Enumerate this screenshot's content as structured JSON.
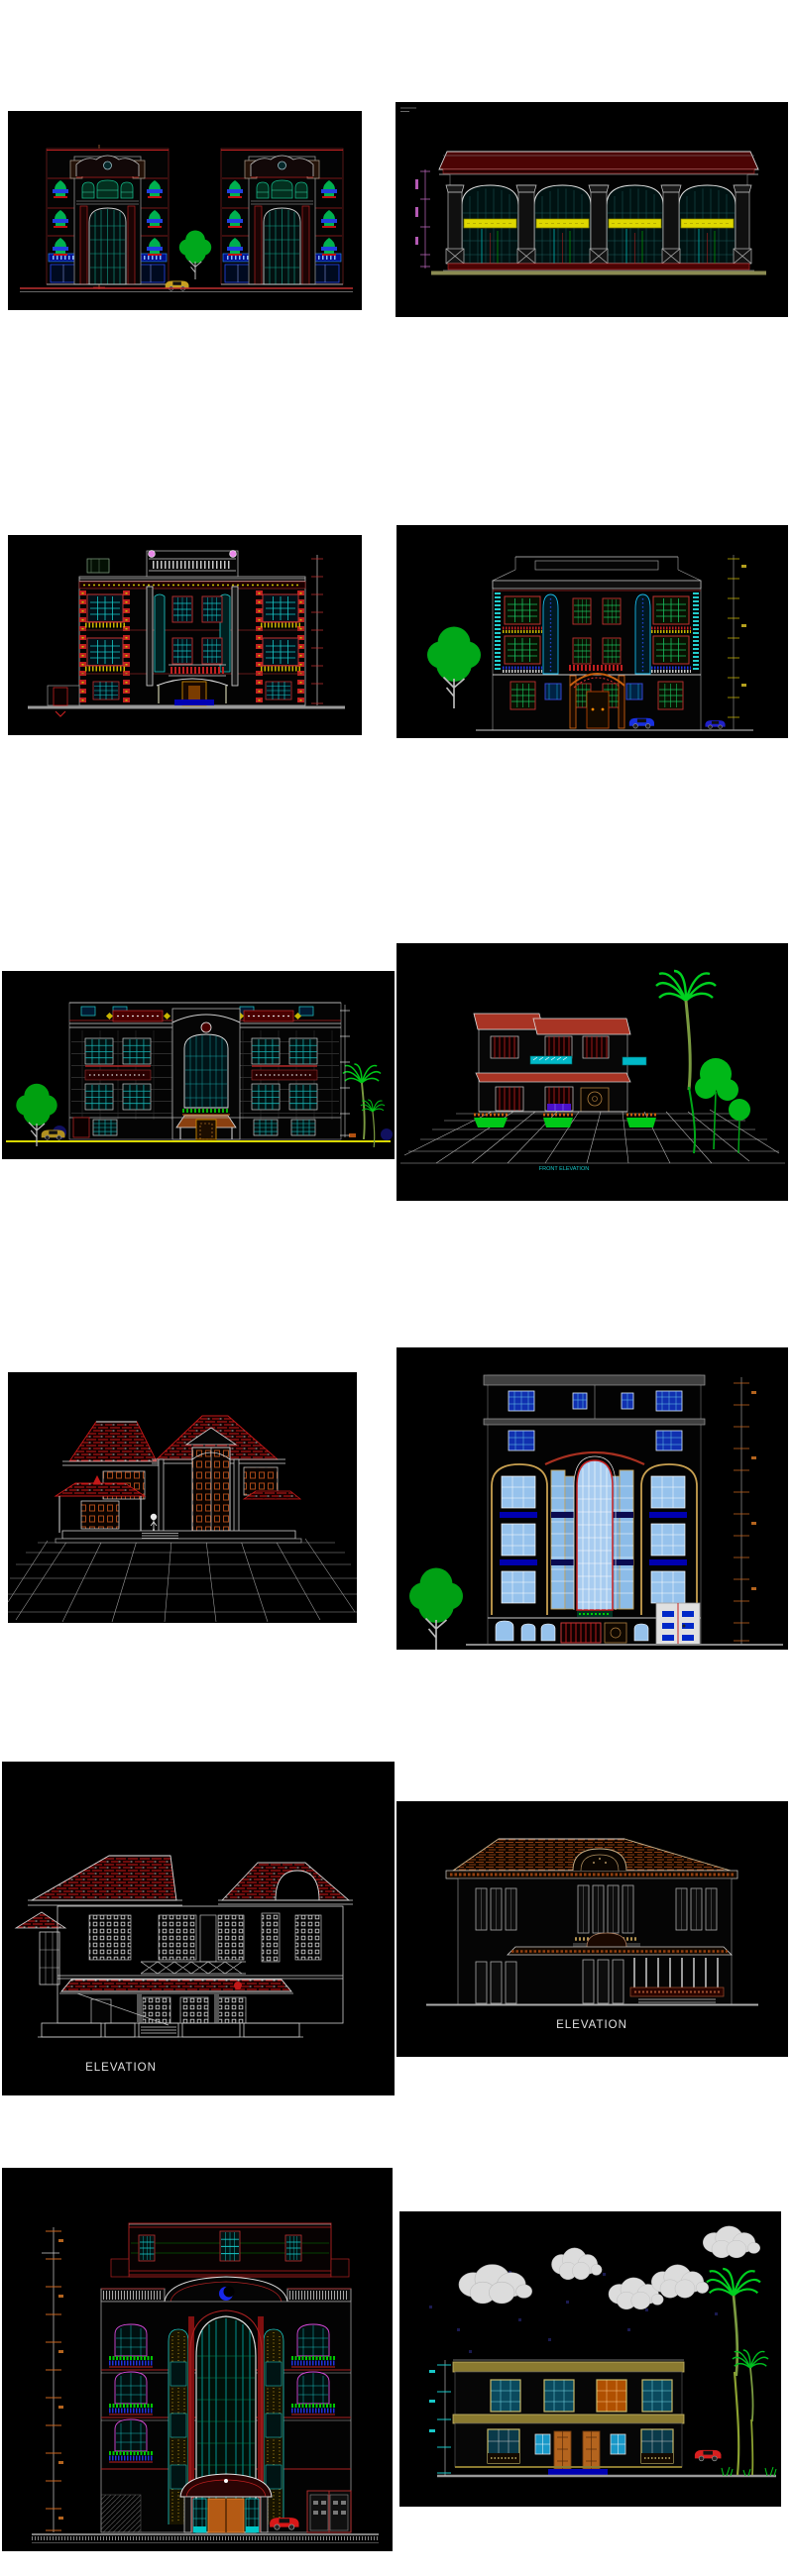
{
  "page": {
    "background": "#ffffff",
    "panel_background": "#000000",
    "caption_color": "#e0e0e0"
  },
  "palette": {
    "cad_red": "#c02020",
    "dark_red": "#4c0404",
    "yellow": "#ded800",
    "cyan": "#12c8c8",
    "teal": "#14b284",
    "green": "#00b400",
    "bright_green": "#00d020",
    "blue": "#2233dd",
    "royal_blue": "#0000b4",
    "light_blue": "#96c2ec",
    "magenta": "#d848d8",
    "orange": "#b4641e",
    "tan": "#c8a050",
    "khaki": "#8a7a30",
    "olive_ground": "#8a8a52",
    "gray": "#8a8a8a",
    "light_gray": "#d8d8d8",
    "cloud_gray": "#dcdcdc"
  },
  "panels": [
    {
      "name": "twin-retail-building-elevation",
      "caption": ""
    },
    {
      "name": "arched-warehouse-elevation",
      "caption": ""
    },
    {
      "name": "classical-villa-front-elevation",
      "caption": ""
    },
    {
      "name": "villa-rear-elevation-with-tree",
      "caption": ""
    },
    {
      "name": "wide-mansion-elevation",
      "caption": ""
    },
    {
      "name": "perspective-villa-with-palms",
      "caption": "FRONT ELEVATION"
    },
    {
      "name": "red-tile-roof-house-perspective",
      "caption": ""
    },
    {
      "name": "apartment-tower-blue-glazing",
      "caption": ""
    },
    {
      "name": "two-storey-house-line-elevation",
      "caption": "ELEVATION"
    },
    {
      "name": "hip-roof-villa-elevation",
      "caption": "ELEVATION"
    },
    {
      "name": "six-storey-residential-tower-elevation",
      "caption": ""
    },
    {
      "name": "villa-elevation-with-clouds-and-palms",
      "caption": ""
    }
  ]
}
